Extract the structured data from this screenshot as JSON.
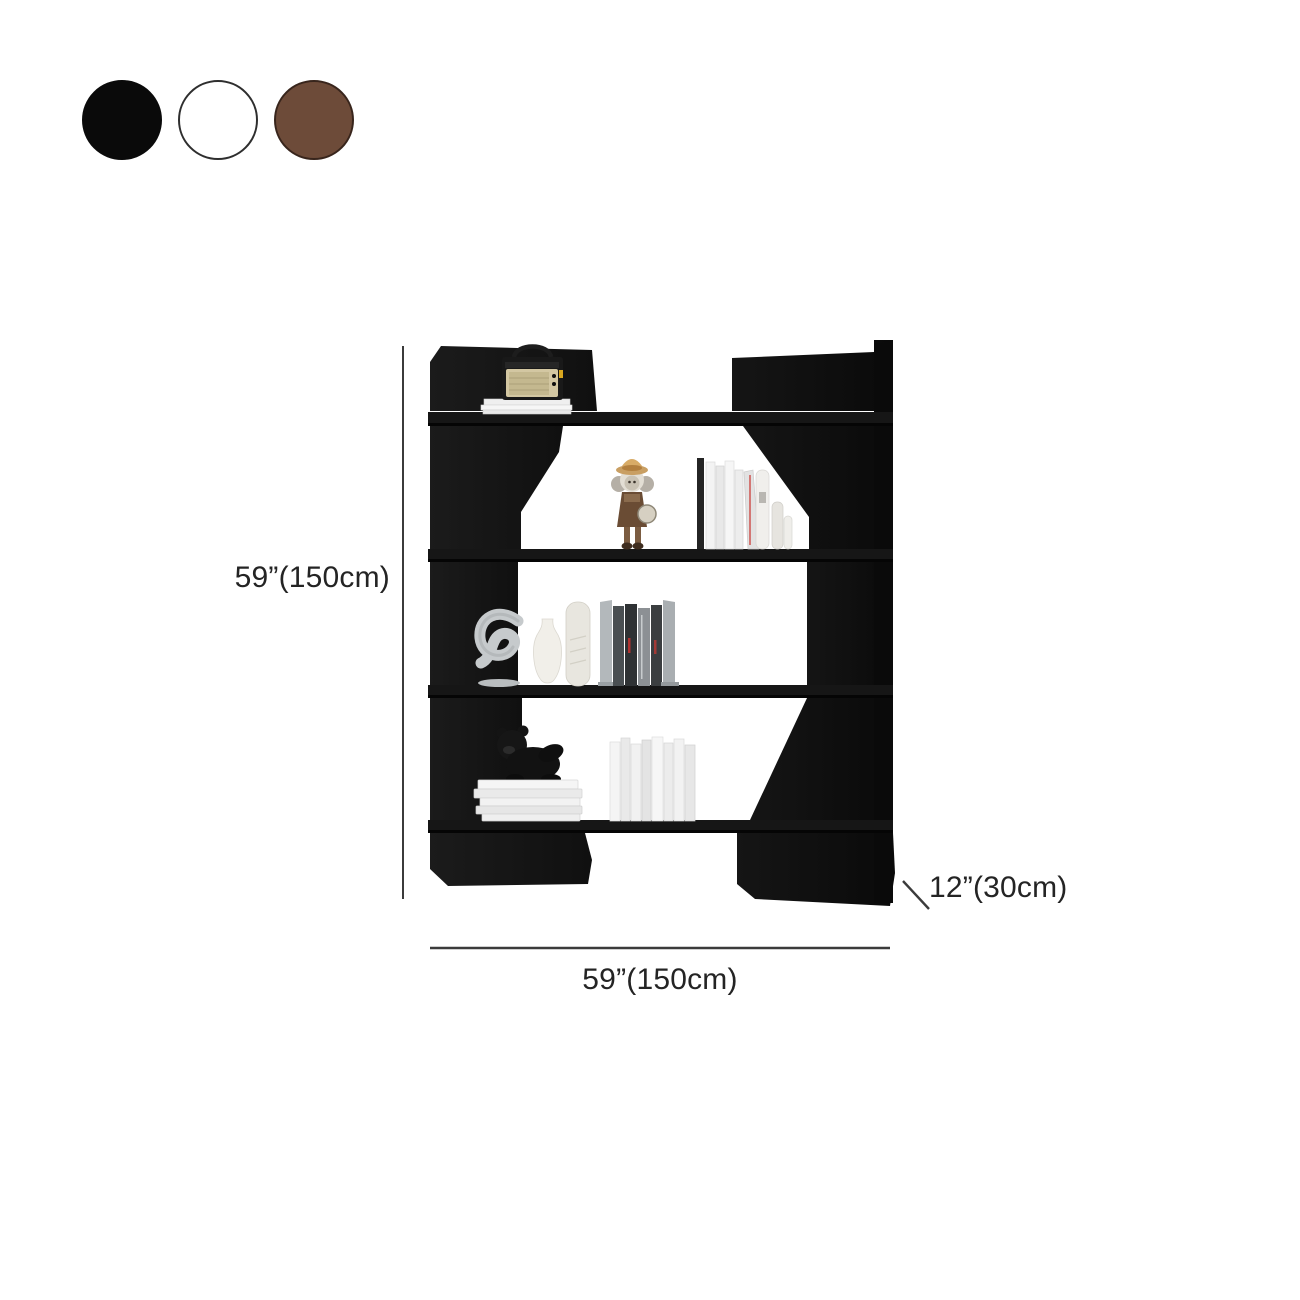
{
  "product": {
    "type_note": "bookshelf dimension diagram",
    "swatches": {
      "items": [
        {
          "name": "black",
          "color": "#0a0a0a",
          "border": "#0a0a0a"
        },
        {
          "name": "white",
          "color": "#ffffff",
          "border": "#2e2e2e"
        },
        {
          "name": "brown",
          "color": "#6d4b39",
          "border": "#38251c"
        }
      ]
    },
    "dimensions": {
      "height_label": "59”(150cm)",
      "width_label": "59”(150cm)",
      "depth_label": "12”(30cm)"
    },
    "colors": {
      "panel_black": "#161616",
      "panel_dark": "#0b0b0b",
      "dimension_line": "#3b3b3b",
      "label_text": "#242424",
      "background": "#ffffff"
    }
  }
}
